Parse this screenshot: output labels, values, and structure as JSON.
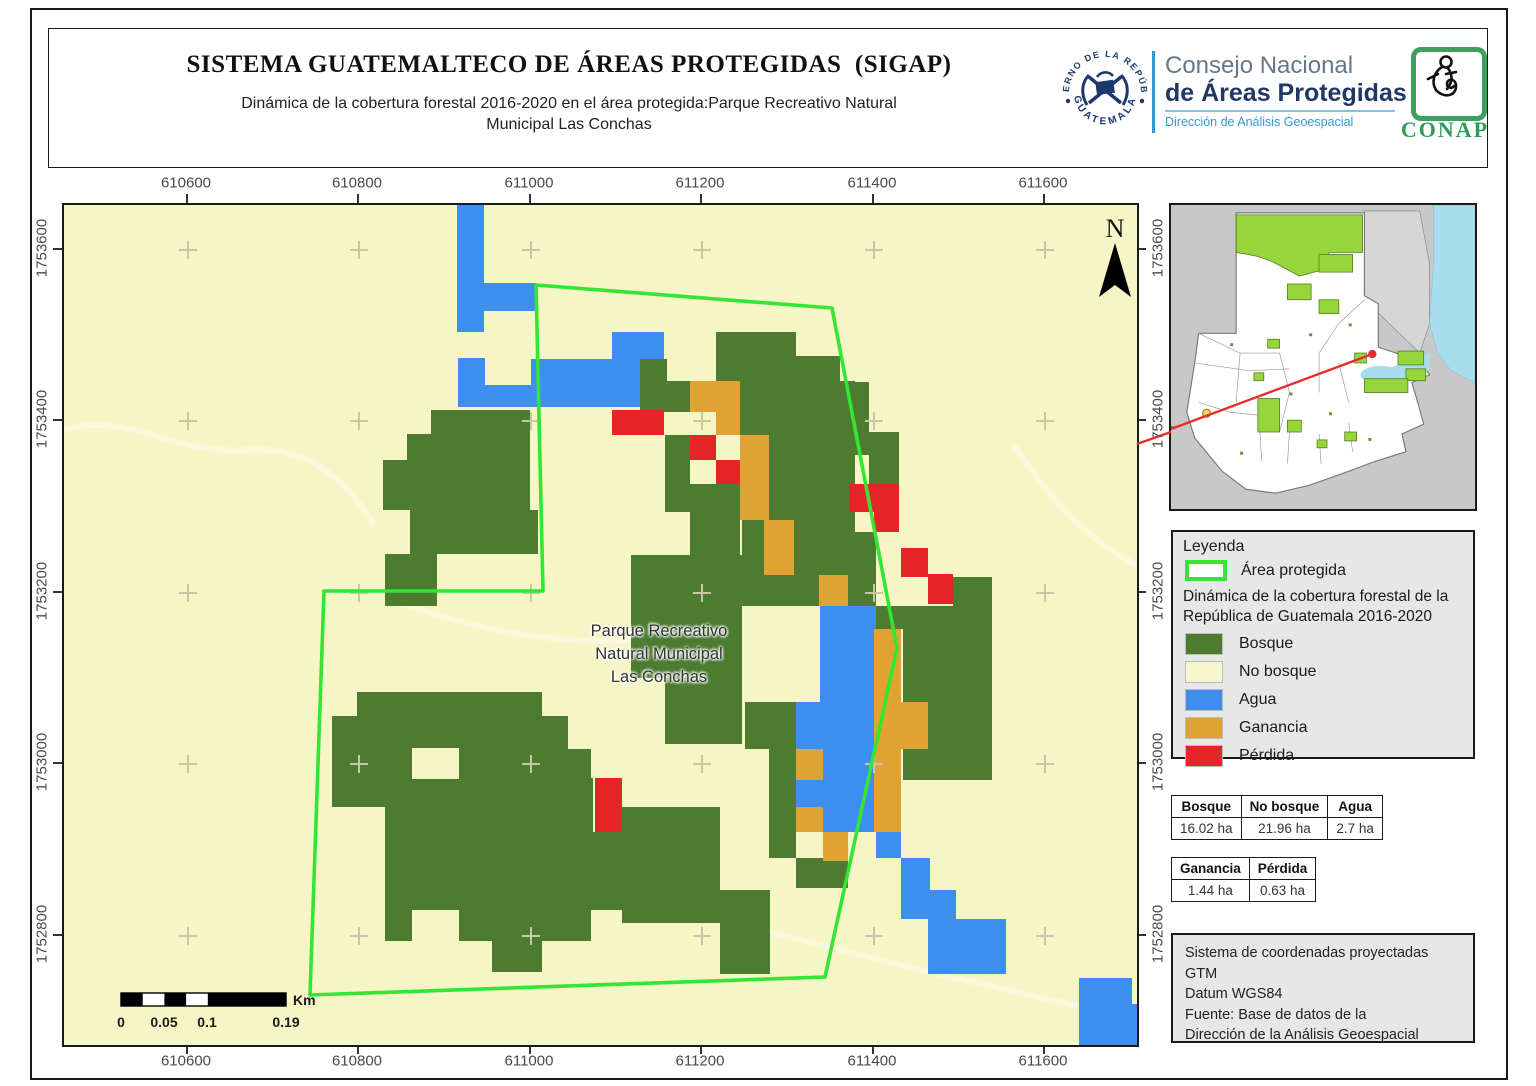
{
  "header": {
    "title": "SISTEMA GUATEMALTECO DE ÁREAS PROTEGIDAS  (SIGAP)",
    "subtitle": "Dinámica de la cobertura forestal 2016-2020 en el área protegida:Parque Recreativo Natural\nMunicipal Las Conchas"
  },
  "logos": {
    "seal_top": "GOBIERNO DE LA REPÚBLICA",
    "seal_bottom": "GUATEMALA",
    "council_line1": "Consejo Nacional",
    "council_line2": "de Áreas Protegidas",
    "council_line3": "Dirección de Análisis Geoespacial",
    "conap_acronym": "CONAP"
  },
  "map": {
    "north_label": "N",
    "park_label_lines": [
      "Parque Recreativo",
      "Natural Municipal",
      "Las Conchas"
    ],
    "x_axis": {
      "labels": [
        "610600",
        "610800",
        "611000",
        "611200",
        "611400",
        "611600"
      ],
      "px": [
        186,
        357,
        529,
        700,
        872,
        1043
      ]
    },
    "y_axis": {
      "labels": [
        "1753600",
        "1753400",
        "1753200",
        "1753000",
        "1752800"
      ],
      "py": [
        248,
        419,
        591,
        762,
        934
      ]
    },
    "colors": {
      "bg": "#F5F5C6",
      "bosque": "#4D7C31",
      "agua": "#3E8EF0",
      "ganancia": "#DFA233",
      "perdida": "#E32527",
      "polygon": "#33E633",
      "cross": "#C9C6A8",
      "road": "#FAF8DC"
    },
    "raster": {
      "bosque": [
        [
          367,
          205,
          99,
          50
        ],
        [
          343,
          229,
          24,
          26
        ],
        [
          319,
          255,
          147,
          50
        ],
        [
          346,
          305,
          128,
          44
        ],
        [
          321,
          349,
          52,
          52
        ],
        [
          652,
          127,
          80,
          26
        ],
        [
          652,
          151,
          124,
          26
        ],
        [
          576,
          154,
          27,
          51
        ],
        [
          597,
          176,
          31,
          31
        ],
        [
          676,
          176,
          115,
          54
        ],
        [
          776,
          177,
          29,
          53
        ],
        [
          791,
          227,
          44,
          23
        ],
        [
          805,
          250,
          30,
          29
        ],
        [
          601,
          230,
          25,
          77
        ],
        [
          626,
          279,
          50,
          71
        ],
        [
          705,
          230,
          86,
          97
        ],
        [
          678,
          310,
          25,
          60
        ],
        [
          730,
          327,
          25,
          74
        ],
        [
          755,
          327,
          57,
          43
        ],
        [
          784,
          370,
          28,
          31
        ],
        [
          812,
          401,
          27,
          23
        ],
        [
          678,
          370,
          77,
          31
        ],
        [
          567,
          350,
          111,
          123
        ],
        [
          601,
          473,
          77,
          66
        ],
        [
          681,
          497,
          51,
          47
        ],
        [
          705,
          544,
          27,
          109
        ],
        [
          732,
          653,
          52,
          30
        ],
        [
          839,
          401,
          89,
          174
        ],
        [
          889,
          372,
          39,
          29
        ],
        [
          293,
          487,
          185,
          26
        ],
        [
          268,
          511,
          236,
          62
        ],
        [
          504,
          544,
          23,
          29
        ],
        [
          268,
          573,
          53,
          29
        ],
        [
          321,
          573,
          208,
          98
        ],
        [
          321,
          671,
          206,
          65
        ],
        [
          428,
          736,
          50,
          31
        ],
        [
          504,
          627,
          54,
          78
        ],
        [
          558,
          602,
          98,
          116
        ],
        [
          656,
          685,
          50,
          84
        ]
      ],
      "agua": [
        [
          393,
          0,
          27,
          127
        ],
        [
          420,
          78,
          52,
          28
        ],
        [
          394,
          153,
          27,
          49
        ],
        [
          421,
          180,
          46,
          22
        ],
        [
          467,
          154,
          109,
          48
        ],
        [
          548,
          127,
          52,
          27
        ],
        [
          756,
          401,
          56,
          226
        ],
        [
          732,
          497,
          27,
          47
        ],
        [
          732,
          575,
          27,
          27
        ],
        [
          812,
          627,
          25,
          26
        ],
        [
          837,
          653,
          29,
          61
        ],
        [
          866,
          685,
          26,
          29
        ],
        [
          864,
          714,
          78,
          55
        ],
        [
          1015,
          773,
          53,
          67
        ],
        [
          1068,
          799,
          5,
          41
        ]
      ],
      "ganancia": [
        [
          626,
          176,
          26,
          31
        ],
        [
          652,
          176,
          24,
          54
        ],
        [
          676,
          230,
          29,
          85
        ],
        [
          700,
          315,
          30,
          55
        ],
        [
          755,
          370,
          29,
          31
        ],
        [
          732,
          544,
          27,
          31
        ],
        [
          732,
          602,
          27,
          25
        ],
        [
          759,
          627,
          25,
          29
        ],
        [
          810,
          424,
          27,
          203
        ],
        [
          837,
          497,
          27,
          47
        ]
      ],
      "perdida": [
        [
          548,
          205,
          52,
          25
        ],
        [
          626,
          230,
          26,
          25
        ],
        [
          652,
          255,
          24,
          24
        ],
        [
          785,
          279,
          50,
          28
        ],
        [
          810,
          307,
          25,
          20
        ],
        [
          837,
          343,
          27,
          29
        ],
        [
          864,
          369,
          25,
          30
        ],
        [
          531,
          573,
          27,
          54
        ]
      ],
      "holes": [
        [
          652,
          230,
          24,
          25
        ],
        [
          348,
          543,
          47,
          31
        ],
        [
          348,
          705,
          47,
          31
        ]
      ]
    },
    "polygon": [
      [
        472,
        80
      ],
      [
        768,
        103
      ],
      [
        833,
        443
      ],
      [
        761,
        772
      ],
      [
        246,
        790
      ],
      [
        260,
        386
      ],
      [
        479,
        386
      ]
    ],
    "roads": [
      "M0,225 C60,205 110,250 180,245 C240,240 280,270 310,320",
      "M330,395 C420,430 520,445 610,430",
      "M430,640 C560,690 740,740 1010,800 C1030,805 1060,815 1073,820",
      "M950,240 C990,300 1030,340 1073,360"
    ],
    "scalebar": {
      "x": 57,
      "y": 788,
      "w": 165,
      "h": 13,
      "black_segs": [
        [
          57,
          21.7
        ],
        [
          100.4,
          21.7
        ],
        [
          143.8,
          78.2
        ]
      ],
      "white_segs": [
        [
          78.7,
          21.7
        ],
        [
          122.1,
          21.7
        ]
      ],
      "labels": [
        "0",
        "0.05",
        "0.1",
        "0.19"
      ],
      "label_x": [
        57,
        100,
        143,
        222
      ],
      "unit": "Km"
    }
  },
  "legend": {
    "title": "Leyenda",
    "area_label": "Área protegida",
    "class_header": "Dinámica de la cobertura forestal de la\nRepública de Guatemala 2016-2020",
    "items": [
      {
        "label": "Bosque",
        "color": "#4D7C31"
      },
      {
        "label": "No bosque",
        "color": "#F7F7CF"
      },
      {
        "label": "Agua",
        "color": "#3E8EF0"
      },
      {
        "label": "Ganancia",
        "color": "#DFA233"
      },
      {
        "label": "Pérdida",
        "color": "#E32527"
      }
    ]
  },
  "tables": {
    "t1": {
      "headers": [
        "Bosque",
        "No bosque",
        "Agua"
      ],
      "values": [
        "16.02 ha",
        "21.96 ha",
        "2.7 ha"
      ]
    },
    "t2": {
      "headers": [
        "Ganancia",
        "Pérdida"
      ],
      "values": [
        "1.44 ha",
        "0.63 ha"
      ]
    }
  },
  "source_box": {
    "text": "Sistema de coordenadas proyectadas\nGTM\nDatum WGS84\nFuente: Base de datos de la\nDirección de la Análisis Geoespacial"
  }
}
